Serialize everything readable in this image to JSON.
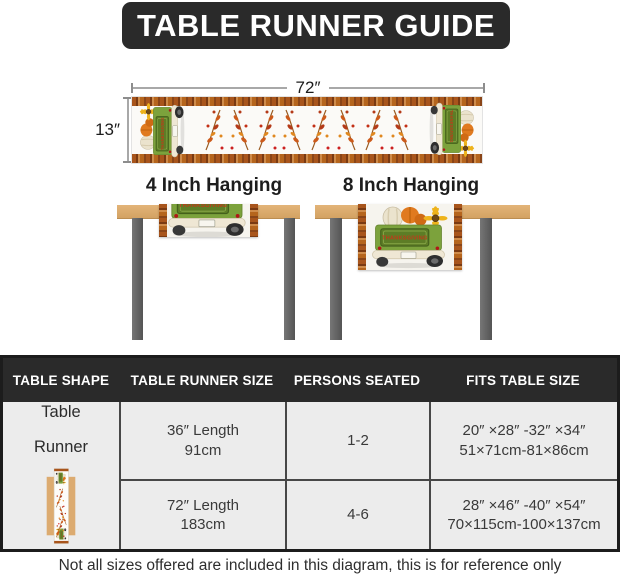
{
  "title": "TABLE RUNNER GUIDE",
  "runner_diagram": {
    "width_label": "72″",
    "height_label": "13″"
  },
  "hanging_sections": {
    "left_title": "4 Inch Hanging",
    "right_title": "8 Inch Hanging",
    "tailgate_text": "THANKSGIVING"
  },
  "size_table": {
    "headers": [
      "TABLE SHAPE",
      "TABLE RUNNER SIZE",
      "PERSONS SEATED",
      "FITS TABLE SIZE"
    ],
    "shape": {
      "line1": "Table",
      "line2": "Runner"
    },
    "rows": [
      {
        "runner_size_line1": "36″ Length",
        "runner_size_line2": "91cm",
        "persons_seated": "1-2",
        "fits_line1": "20″ ×28″ -32″ ×34″",
        "fits_line2": "51×71cm-81×86cm"
      },
      {
        "runner_size_line1": "72″ Length",
        "runner_size_line2": "183cm",
        "persons_seated": "4-6",
        "fits_line1": "28″ ×46″ -40″ ×54″",
        "fits_line2": "70×115cm-100×137cm"
      }
    ]
  },
  "footnote": "Not all sizes offered are included in this diagram, this is for reference only",
  "colors": {
    "banner_bg": "#2a2a2a",
    "table_header_bg": "#2a2a2a",
    "table_body_bg": "#ececec",
    "wood_tan": "#dcab70",
    "leg_gray": "#606060",
    "truck_green": "#7ca23c",
    "tailgate_green": "#5d7d26",
    "plaid_orange": "#b5651d",
    "leaf_orange": "#cc5a1a",
    "leaf_red": "#b43a18",
    "tailgate_text_red": "#c03a1a"
  }
}
